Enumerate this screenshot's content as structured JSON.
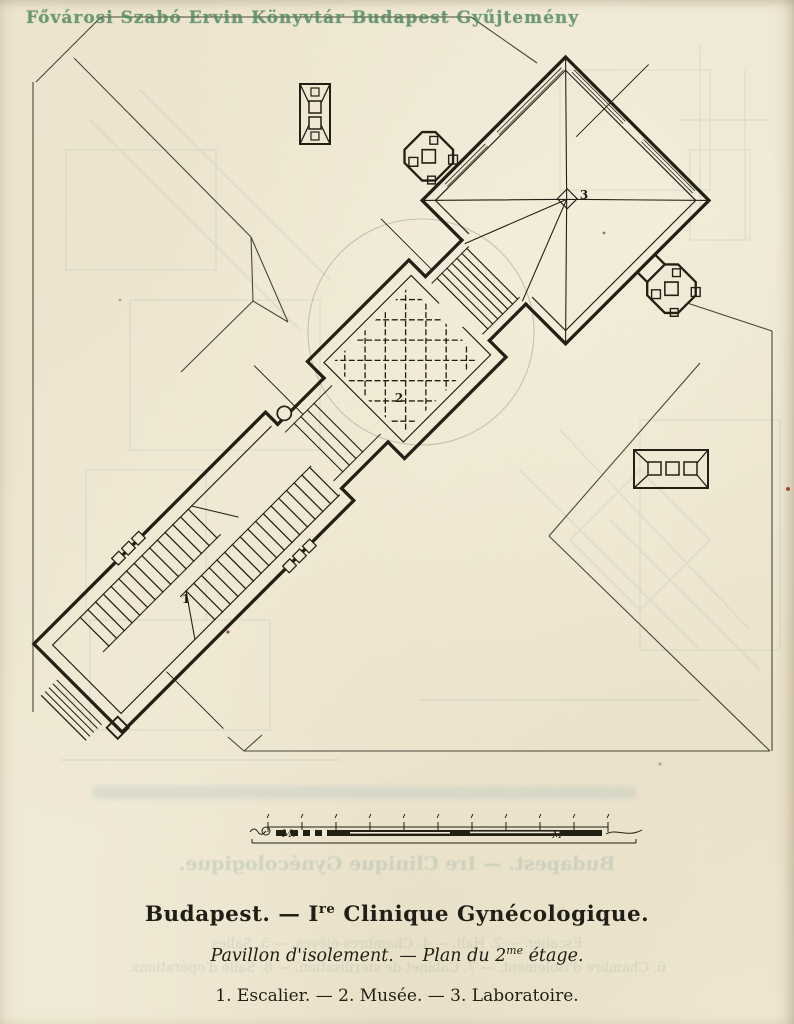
{
  "watermark": {
    "text": "Fővárosi Szabó Ervin Könyvtár Budapest Gyűjtemény"
  },
  "plan": {
    "labels": {
      "escalier": "1",
      "musee": "2",
      "laboratoire": "3"
    }
  },
  "scale_bar": {
    "left_label": "M.",
    "right_label": "M"
  },
  "captions": {
    "title_pre": "Budapest. — I",
    "title_sup": "re",
    "title_post": " Clinique Gynécologique.",
    "subtitle_pre": "Pavillon d'isolement. — Plan du 2",
    "subtitle_sup": "me",
    "subtitle_post": " étage.",
    "legend": "1. Escalier. — 2. Musée. — 3. Laboratoire."
  },
  "bleedthrough": {
    "title": "Budapest. — Ire Clinique Gynécologique.",
    "line1": "Escalier. — 2. Hall. — 4. Chambres-élèves. — 5. Salles",
    "line2": "6. Chambre d'isolement. — 7. Cabinet de stérilisation. — 8. Salle d'opérations."
  },
  "colors": {
    "paper": "#f0e9d5",
    "ink": "#221f15",
    "watermark_green": "#4e8a5e",
    "bleed_blue": "#7fa3b5"
  }
}
